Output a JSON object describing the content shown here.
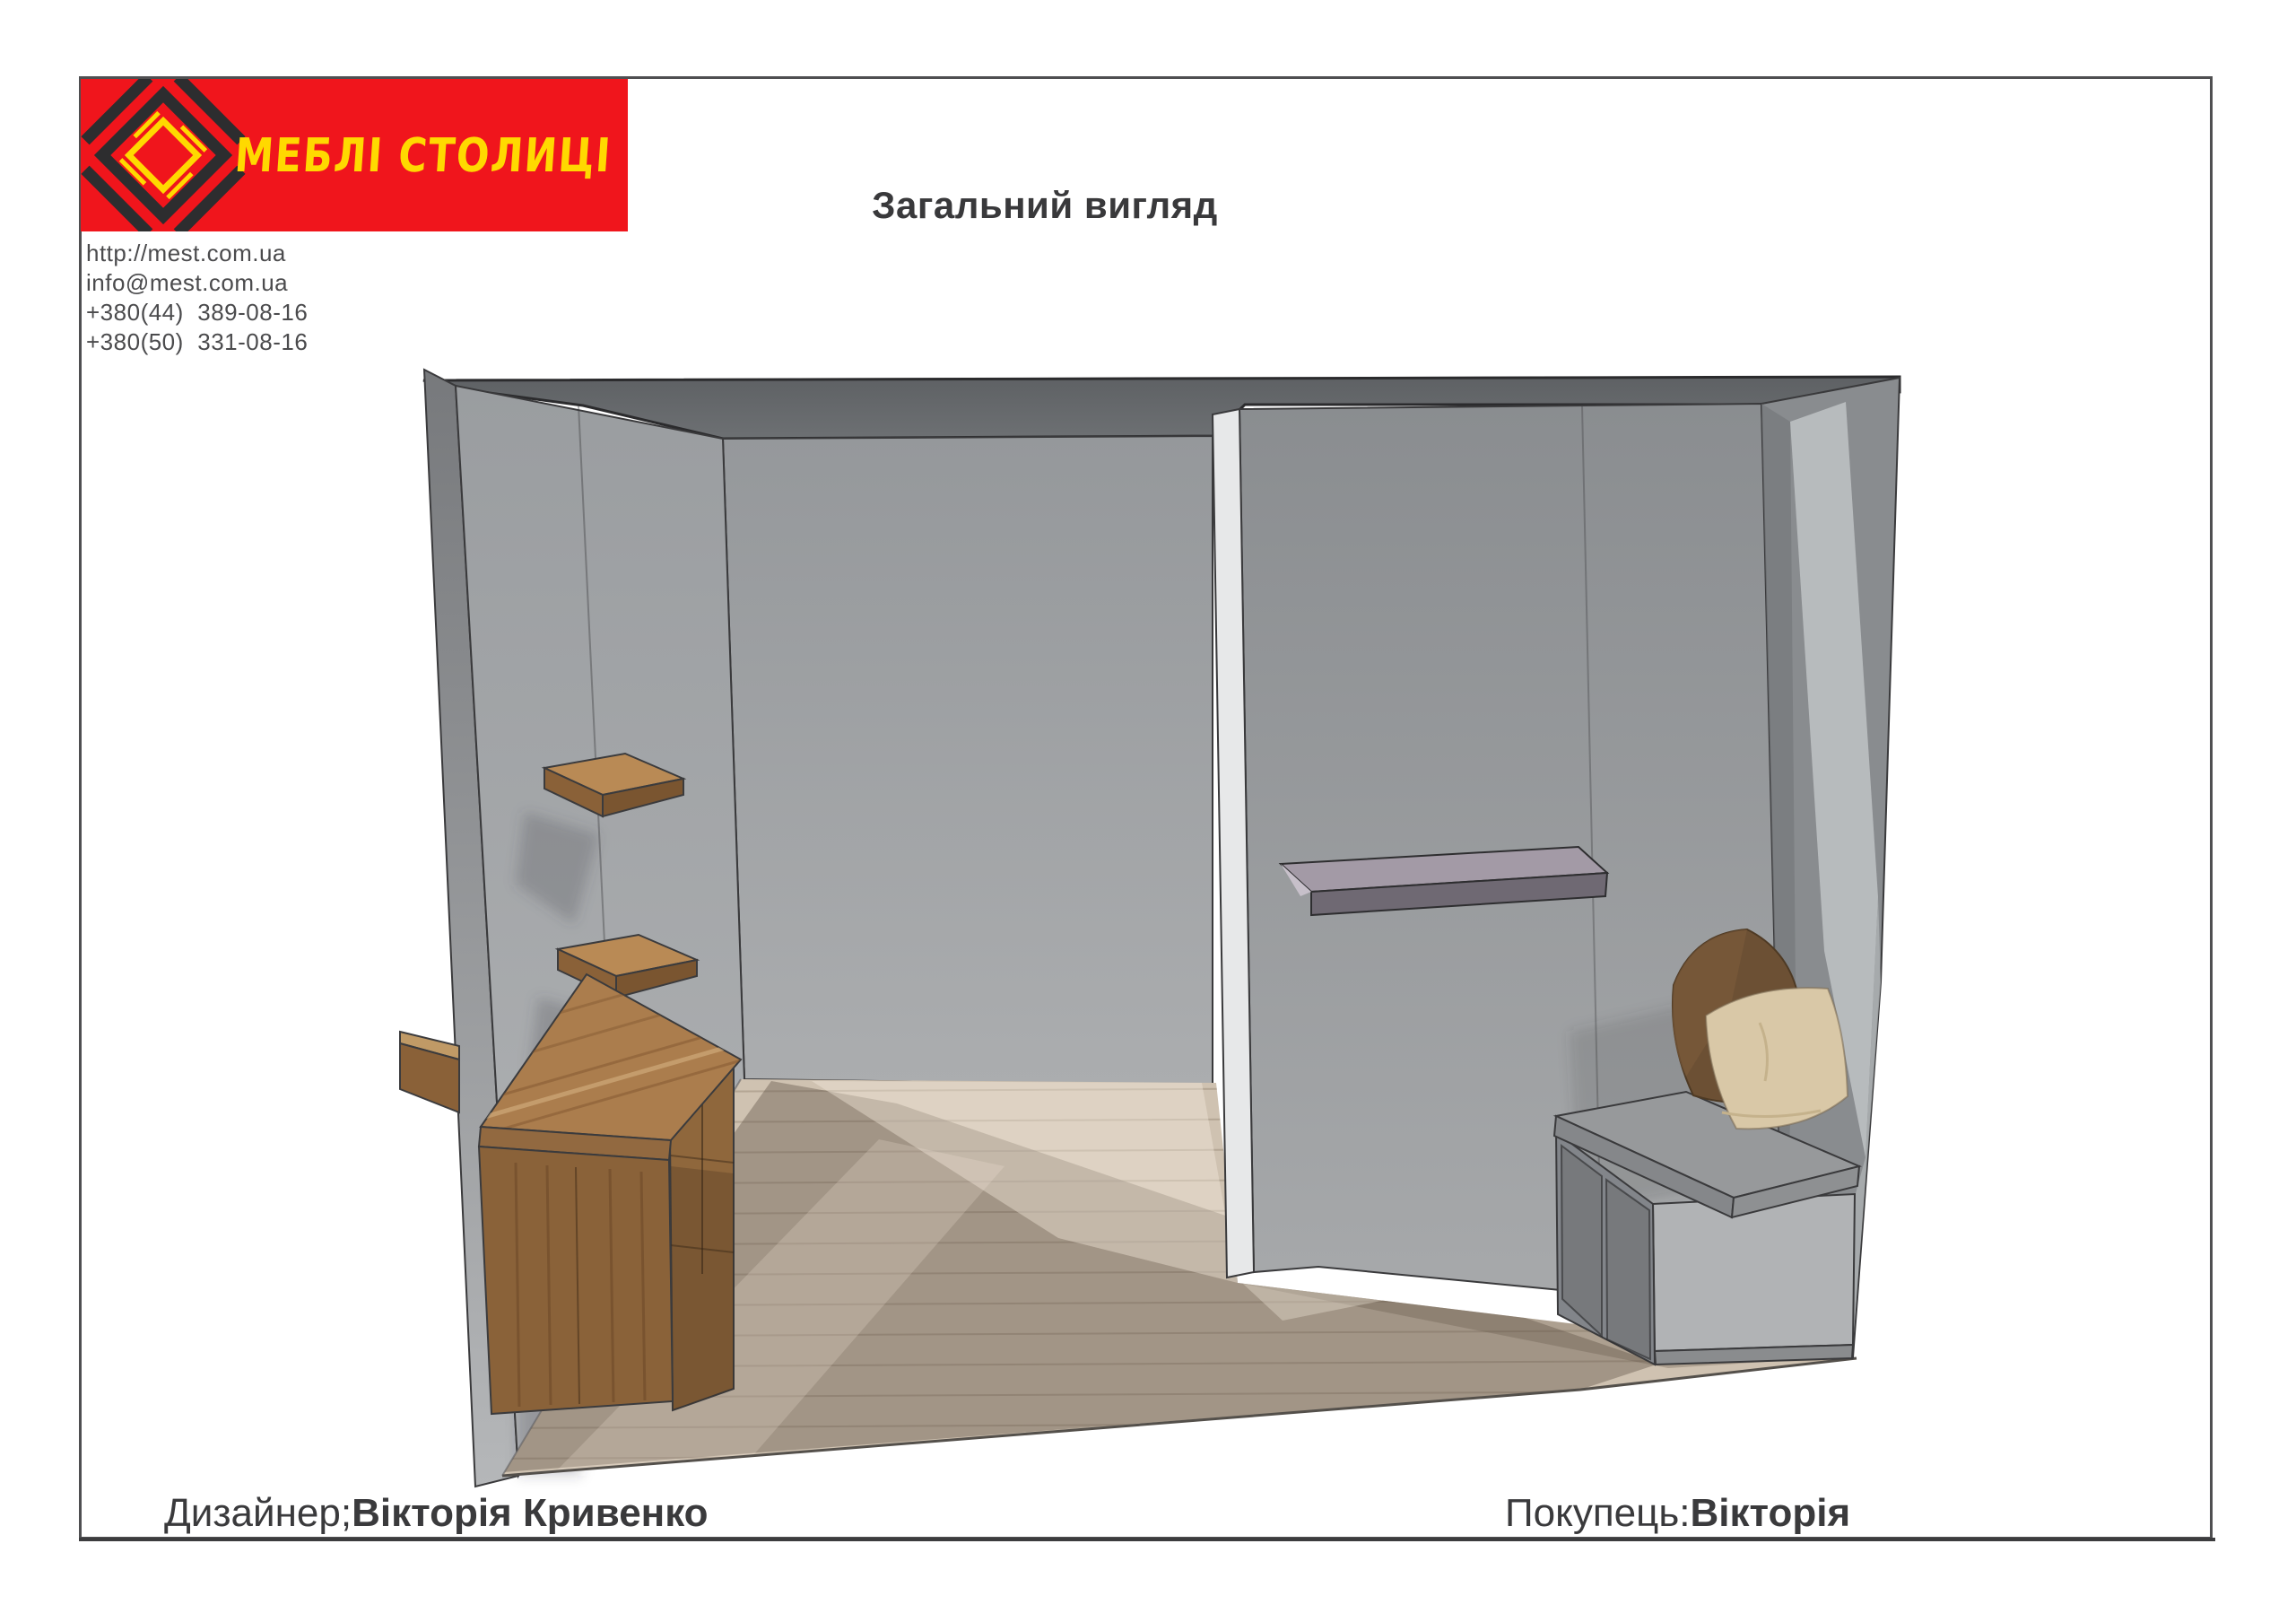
{
  "logo": {
    "brand": "МЕБЛІ СТОЛИЦІ",
    "banner_color": "#f0151c",
    "text_color": "#ffd900",
    "mark_dark": "#2d2d2f"
  },
  "contacts": {
    "website": "http://mest.com.ua",
    "email": "info@mest.com.ua",
    "phone1": "+380(44)  389-08-16",
    "phone2": "+380(50)  331-08-16"
  },
  "header": {
    "title": "Загальний вигляд"
  },
  "footer": {
    "designer_label": "Дизайнер;",
    "designer_name": "Вікторія Кривенко",
    "customer_label": "Покупець:",
    "customer_name": "Вікторія"
  },
  "render": {
    "alt": "3D перспектива передпокою: стіна з двома дерев'яними поличками, дерев'яна консоль з тумбою, висока сіра панель з рейлом-поличкою та лава з шухлядами і двома подушками",
    "colors": {
      "ceiling": "#63666a",
      "walls": "#9a9da0",
      "partition_edge": "#e7e8e9",
      "wood": "#a97c4e",
      "wood_dark": "#8a6239",
      "floor": "#cfc2b1",
      "floor_shadow": "#5f5346",
      "bench": "#b1b3b5",
      "cushion_brown": "#6c5034",
      "cushion_cream": "#d9c8a7",
      "rail": "#6f6973"
    }
  }
}
